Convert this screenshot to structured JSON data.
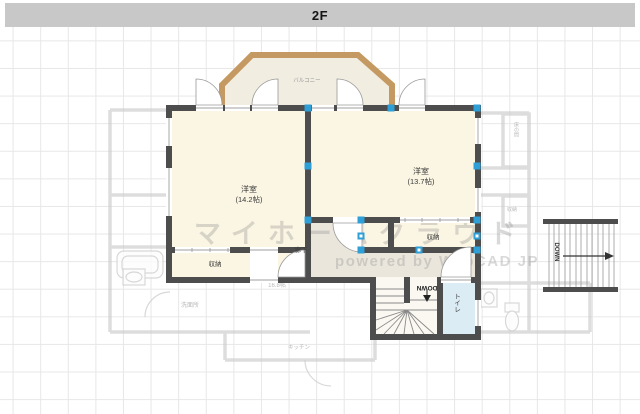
{
  "header": {
    "title": "2F"
  },
  "watermark": {
    "brand": "マイホームクラウド",
    "powered": "powered by WebCAD JP"
  },
  "plan": {
    "balcony_label": "バルコニー",
    "room_left": {
      "name": "洋室",
      "area": "(14.2帖)"
    },
    "room_right": {
      "name": "洋室",
      "area": "(13.7帖)"
    },
    "closet_left": "収納",
    "closet_right": "収納",
    "hallway": "廊下",
    "toilet": "トイレ",
    "stairs_down": "DOWN",
    "stairs_right_down": "DOWN"
  },
  "background_1f": {
    "washroom": "洗面所",
    "kitchen": "キッチン",
    "alcove": "床の間",
    "closet": "収納",
    "area": "16.8帖"
  },
  "colors": {
    "titlebar": "#c8c8c8",
    "wall": "#4d4d4d",
    "room_fill": "#fbf6e3",
    "hall_fill": "#eae6dc",
    "stair_fill": "#faf8f0",
    "toilet_fill": "#dcecf4",
    "balcony_fill": "#f1ede1",
    "balcony_border": "#c49a62",
    "handle": "#2e9fd7",
    "grid_line": "#e7e7e7"
  }
}
